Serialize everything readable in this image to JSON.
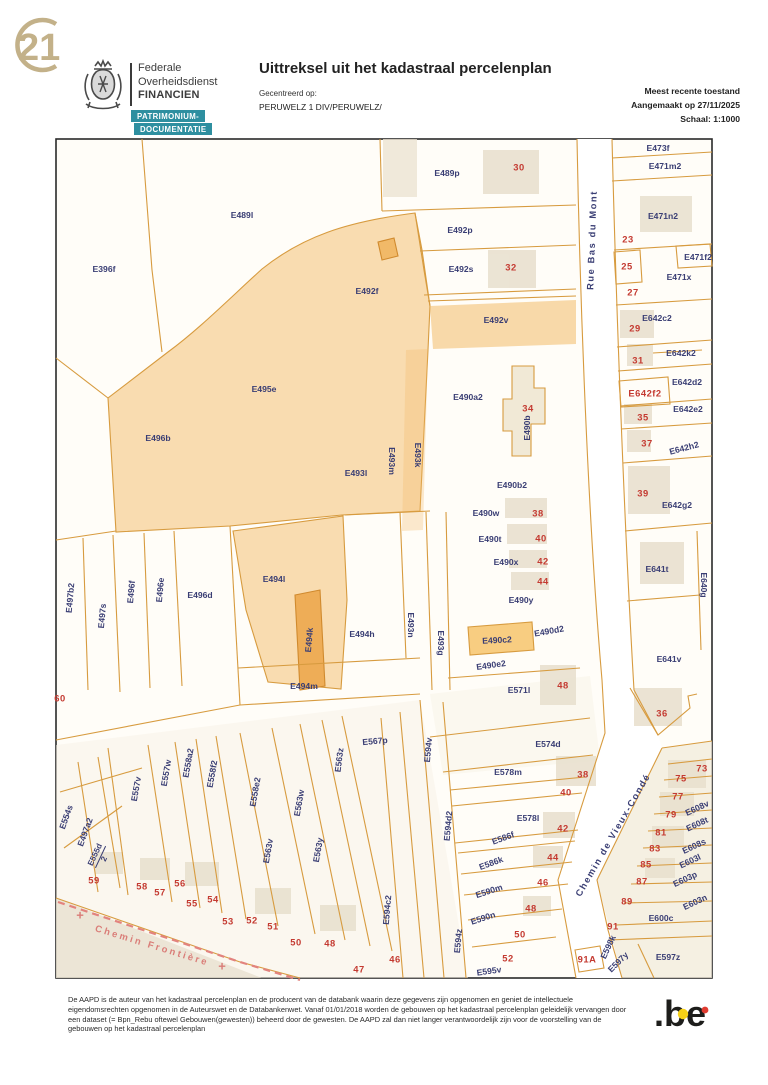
{
  "header": {
    "corner_logo_text": "21",
    "org_line1": "Federale",
    "org_line2": "Overheidsdienst",
    "org_line3": "FINANCIEN",
    "badge1": "PATRIMONIUM-",
    "badge2": "DOCUMENTATIE",
    "title": "Uittreksel uit het kadastraal percelenplan",
    "centered_label": "Gecentreerd op:",
    "centered_value": "PERUWELZ 1 DIV/PERUWELZ/",
    "status_line": "Meest recente toestand",
    "created_line": "Aangemaakt op 27/11/2025",
    "scale_line": "Schaal: 1:1000"
  },
  "footer": {
    "disclaimer": "De AAPD is de auteur van het kadastraal percelenplan en de producent van de databank waarin deze gegevens zijn opgenomen en geniet de intellectuele eigendomsrechten opgenomen in de Auteurswet en de Databankenwet. Vanaf 01/01/2018 worden de gebouwen op het kadastraal percelenplan geleidelijk vervangen door een dataset (= Bpn_Rebu oftewel Gebouwen(gewesten)) beheerd door de gewesten. De AAPD zal dan niet langer verantwoordelijk zijn voor de voorstelling van de gebouwen op het kadastraal percelenplan",
    "be_logo": ".be"
  },
  "colors": {
    "parcel_text": "#3a3e74",
    "house_number": "#c43a31",
    "parcel_line": "#d79b3f",
    "parcel_fill": "#f3bb67",
    "badge_teal": "#2e8fa0",
    "logo_gold": "#c3b189",
    "frontier_pink": "#da7d78",
    "be_yellow": "#f7d117",
    "be_red": "#e03c31"
  },
  "map": {
    "columns": [
      "text",
      "x",
      "y",
      "rotation",
      "kind"
    ],
    "kinds": {
      "p": "parcel-code",
      "r": "house-number",
      "s": "street-name",
      "sp": "street-name-frontier",
      "f": "fraction-parcel-code",
      "x": "boundary-cross"
    },
    "street_names": [
      "Rue Bas du Mont",
      "Chemin de Vieux-Condé",
      "Chemin Frontière"
    ],
    "labels": [
      [
        "E489p",
        447,
        173,
        0,
        "p"
      ],
      [
        "E489l",
        242,
        215,
        0,
        "p"
      ],
      [
        "E396f",
        104,
        269,
        0,
        "p"
      ],
      [
        "E492p",
        460,
        230,
        0,
        "p"
      ],
      [
        "E492s",
        461,
        269,
        0,
        "p"
      ],
      [
        "E492f",
        367,
        291,
        0,
        "p"
      ],
      [
        "E492v",
        496,
        320,
        0,
        "p"
      ],
      [
        "E495e",
        264,
        389,
        0,
        "p"
      ],
      [
        "E496b",
        158,
        438,
        0,
        "p"
      ],
      [
        "E493l",
        356,
        473,
        0,
        "p"
      ],
      [
        "E493m",
        392,
        461,
        90,
        "p"
      ],
      [
        "E493k",
        418,
        455,
        90,
        "p"
      ],
      [
        "E490a2",
        468,
        397,
        0,
        "p"
      ],
      [
        "E490b",
        527,
        428,
        -90,
        "p"
      ],
      [
        "E473f",
        658,
        148,
        0,
        "p"
      ],
      [
        "E471m2",
        665,
        166,
        0,
        "p"
      ],
      [
        "E471n2",
        663,
        216,
        0,
        "p"
      ],
      [
        "E471f2",
        698,
        257,
        0,
        "p"
      ],
      [
        "E471x",
        679,
        277,
        0,
        "p"
      ],
      [
        "E642c2",
        657,
        318,
        0,
        "p"
      ],
      [
        "E642k2",
        681,
        353,
        0,
        "p"
      ],
      [
        "E642d2",
        687,
        382,
        0,
        "p"
      ],
      [
        "E642f2",
        645,
        393,
        0,
        "r"
      ],
      [
        "E642e2",
        688,
        409,
        0,
        "p"
      ],
      [
        "E642h2",
        684,
        448,
        -15,
        "p"
      ],
      [
        "E642g2",
        677,
        505,
        0,
        "p"
      ],
      [
        "E490b2",
        512,
        485,
        0,
        "p"
      ],
      [
        "E490w",
        486,
        513,
        0,
        "p"
      ],
      [
        "E490t",
        490,
        539,
        0,
        "p"
      ],
      [
        "E490x",
        506,
        562,
        0,
        "p"
      ],
      [
        "E490y",
        521,
        600,
        0,
        "p"
      ],
      [
        "E490c2",
        497,
        640,
        -3,
        "p"
      ],
      [
        "E490d2",
        549,
        631,
        -10,
        "p"
      ],
      [
        "E490e2",
        491,
        665,
        -8,
        "p"
      ],
      [
        "E493n",
        411,
        625,
        90,
        "p"
      ],
      [
        "E493g",
        441,
        643,
        90,
        "p"
      ],
      [
        "E571l",
        519,
        690,
        0,
        "p"
      ],
      [
        "E641t",
        657,
        569,
        0,
        "p"
      ],
      [
        "E640g",
        704,
        585,
        90,
        "p"
      ],
      [
        "E641v",
        669,
        659,
        0,
        "p"
      ],
      [
        "E574d",
        548,
        744,
        0,
        "p"
      ],
      [
        "E578m",
        508,
        772,
        0,
        "p"
      ],
      [
        "E578l",
        528,
        818,
        0,
        "p"
      ],
      [
        "E586f",
        503,
        838,
        -20,
        "p"
      ],
      [
        "E586k",
        491,
        863,
        -20,
        "p"
      ],
      [
        "E590m",
        489,
        891,
        -18,
        "p"
      ],
      [
        "E590n",
        483,
        918,
        -18,
        "p"
      ],
      [
        "E595v",
        489,
        971,
        -8,
        "p"
      ],
      [
        "E594z",
        458,
        941,
        -85,
        "p"
      ],
      [
        "E594d2",
        448,
        826,
        -85,
        "p"
      ],
      [
        "E594v",
        428,
        750,
        -85,
        "p"
      ],
      [
        "E594c2",
        387,
        910,
        -85,
        "p"
      ],
      [
        "E567p",
        375,
        741,
        -5,
        "p"
      ],
      [
        "E563z",
        339,
        760,
        -83,
        "p"
      ],
      [
        "E563w",
        299,
        803,
        -80,
        "p"
      ],
      [
        "E563y",
        318,
        850,
        -80,
        "p"
      ],
      [
        "E563v",
        268,
        851,
        -80,
        "p"
      ],
      [
        "E558e2",
        255,
        792,
        -80,
        "p"
      ],
      [
        "E558f2",
        212,
        774,
        -80,
        "p"
      ],
      [
        "E558a2",
        188,
        763,
        -80,
        "p"
      ],
      [
        "E557w",
        166,
        773,
        -80,
        "p"
      ],
      [
        "E557v",
        136,
        789,
        -80,
        "p"
      ],
      [
        "E554s",
        66,
        817,
        -70,
        "p"
      ],
      [
        "E497a2",
        85,
        832,
        -70,
        "p"
      ],
      [
        "E555d|2",
        100,
        857,
        -65,
        "f"
      ],
      [
        "E497b2",
        70,
        598,
        -85,
        "p"
      ],
      [
        "E497s",
        102,
        616,
        -85,
        "p"
      ],
      [
        "E496f",
        131,
        592,
        -85,
        "p"
      ],
      [
        "E496e",
        160,
        590,
        -85,
        "p"
      ],
      [
        "E496d",
        200,
        595,
        0,
        "p"
      ],
      [
        "E494l",
        274,
        579,
        0,
        "p"
      ],
      [
        "E494k",
        309,
        640,
        -85,
        "p"
      ],
      [
        "E494h",
        362,
        634,
        0,
        "p"
      ],
      [
        "E494m",
        304,
        686,
        0,
        "p"
      ],
      [
        "E608v",
        697,
        808,
        -25,
        "p"
      ],
      [
        "E608t",
        697,
        824,
        -25,
        "p"
      ],
      [
        "E608s",
        694,
        846,
        -25,
        "p"
      ],
      [
        "E603l",
        690,
        861,
        -25,
        "p"
      ],
      [
        "E603p",
        685,
        879,
        -25,
        "p"
      ],
      [
        "E603n",
        695,
        902,
        -25,
        "p"
      ],
      [
        "E600c",
        661,
        918,
        0,
        "p"
      ],
      [
        "E598k",
        608,
        947,
        -65,
        "p"
      ],
      [
        "E597y",
        618,
        962,
        -45,
        "p"
      ],
      [
        "E597z",
        668,
        957,
        0,
        "p"
      ],
      [
        "30",
        519,
        167,
        0,
        "r"
      ],
      [
        "32",
        511,
        267,
        0,
        "r"
      ],
      [
        "23",
        628,
        239,
        0,
        "r"
      ],
      [
        "25",
        627,
        266,
        0,
        "r"
      ],
      [
        "27",
        633,
        292,
        0,
        "r"
      ],
      [
        "29",
        635,
        328,
        0,
        "r"
      ],
      [
        "31",
        638,
        360,
        0,
        "r"
      ],
      [
        "34",
        528,
        408,
        0,
        "r"
      ],
      [
        "35",
        643,
        417,
        0,
        "r"
      ],
      [
        "37",
        647,
        443,
        0,
        "r"
      ],
      [
        "39",
        643,
        493,
        0,
        "r"
      ],
      [
        "38",
        538,
        513,
        0,
        "r"
      ],
      [
        "40",
        541,
        538,
        0,
        "r"
      ],
      [
        "42",
        543,
        561,
        0,
        "r"
      ],
      [
        "44",
        543,
        581,
        0,
        "r"
      ],
      [
        "36",
        662,
        713,
        0,
        "r"
      ],
      [
        "48",
        563,
        685,
        0,
        "r"
      ],
      [
        "38",
        583,
        774,
        0,
        "r"
      ],
      [
        "40",
        566,
        792,
        0,
        "r"
      ],
      [
        "42",
        563,
        828,
        0,
        "r"
      ],
      [
        "44",
        553,
        857,
        0,
        "r"
      ],
      [
        "46",
        543,
        882,
        0,
        "r"
      ],
      [
        "48",
        531,
        908,
        0,
        "r"
      ],
      [
        "50",
        520,
        934,
        0,
        "r"
      ],
      [
        "52",
        508,
        958,
        0,
        "r"
      ],
      [
        "60",
        60,
        698,
        0,
        "r"
      ],
      [
        "59",
        94,
        880,
        0,
        "r"
      ],
      [
        "58",
        142,
        886,
        0,
        "r"
      ],
      [
        "57",
        160,
        892,
        0,
        "r"
      ],
      [
        "56",
        180,
        883,
        0,
        "r"
      ],
      [
        "55",
        192,
        903,
        0,
        "r"
      ],
      [
        "54",
        213,
        899,
        0,
        "r"
      ],
      [
        "53",
        228,
        921,
        0,
        "r"
      ],
      [
        "52",
        252,
        920,
        0,
        "r"
      ],
      [
        "51",
        273,
        926,
        0,
        "r"
      ],
      [
        "50",
        296,
        942,
        0,
        "r"
      ],
      [
        "48",
        330,
        943,
        0,
        "r"
      ],
      [
        "47",
        359,
        969,
        0,
        "r"
      ],
      [
        "46",
        395,
        959,
        0,
        "r"
      ],
      [
        "73",
        702,
        768,
        0,
        "r"
      ],
      [
        "75",
        681,
        778,
        0,
        "r"
      ],
      [
        "77",
        678,
        796,
        0,
        "r"
      ],
      [
        "79",
        671,
        814,
        0,
        "r"
      ],
      [
        "81",
        661,
        832,
        0,
        "r"
      ],
      [
        "83",
        655,
        848,
        0,
        "r"
      ],
      [
        "85",
        646,
        864,
        0,
        "r"
      ],
      [
        "87",
        642,
        881,
        0,
        "r"
      ],
      [
        "89",
        627,
        901,
        0,
        "r"
      ],
      [
        "91",
        613,
        926,
        0,
        "r"
      ],
      [
        "91A",
        587,
        959,
        0,
        "r"
      ],
      [
        "Rue Bas du Mont",
        592,
        240,
        -88,
        "s"
      ],
      [
        "Chemin de Vieux-Condé",
        613,
        835,
        -60,
        "s"
      ],
      [
        "Chemin Frontière",
        152,
        946,
        17,
        "sp"
      ],
      [
        "+",
        80,
        915,
        0,
        "x"
      ],
      [
        "+",
        222,
        966,
        0,
        "x"
      ]
    ]
  }
}
